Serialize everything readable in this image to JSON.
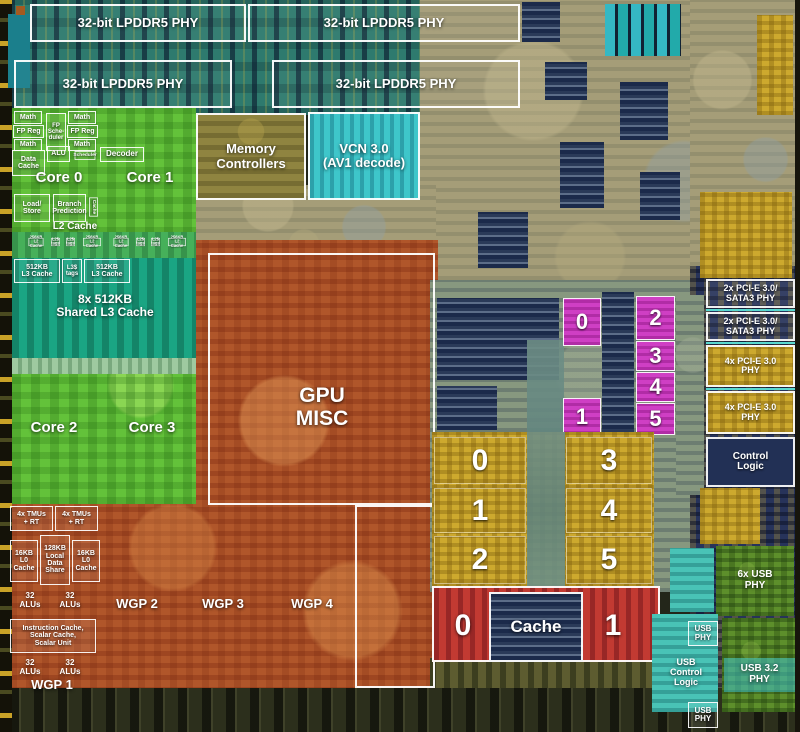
{
  "title": "Annotated APU die shot",
  "colors": {
    "cpu_green": "#63c23a",
    "l3_teal": "#1aa583",
    "gpu_orange": "#b0562a",
    "cu_pink": "#cf3fc4",
    "cu_yellow": "#cda92e",
    "cache_red": "#c23a32",
    "vcn_cyan": "#3ec6ca",
    "phy_teal": "#2e7a6e",
    "io_navy": "#27335a",
    "usb_green": "#5d8f2b",
    "usb_cyan": "#49c3b6",
    "mem_ctrl_olive": "#8f8440"
  },
  "die": {
    "phy": [
      "32-bit LPDDR5 PHY",
      "32-bit LPDDR5 PHY",
      "32-bit LPDDR5 PHY",
      "32-bit LPDDR5 PHY"
    ],
    "cpu": {
      "fpu_col1": [
        "Math",
        "FP Reg",
        "Math"
      ],
      "fp_scheduler": "FP Sche- duler",
      "fpu_col2": [
        "Math",
        "FP Reg",
        "Math"
      ],
      "data_cache": "Data\nCache",
      "alu": "ALU",
      "scheduler": "Scheduler",
      "decoder": "Decoder",
      "core0": "Core 0",
      "core1": "Core 1",
      "load_store": "Load/\nStore",
      "branch_prediction": "Branch\nPrediction",
      "l2_vertical": "Cache",
      "l2_cache": "L2 Cache",
      "l2_row": [
        "256KB\nL2 Cache",
        "L2$\ntags",
        "L2$\ntags",
        "256KB\nL2 Cache"
      ],
      "l3_row": [
        "512KB\nL3 Cache",
        "L3$\ntags",
        "512KB\nL3 Cache"
      ],
      "shared_l3": "8x 512KB\nShared L3 Cache",
      "core2": "Core 2",
      "core3": "Core 3"
    },
    "memory_controllers": "Memory\nControllers",
    "vcn": "VCN 3.0\n(AV1 decode)",
    "gpu_misc": "GPU\nMISC",
    "wgp": {
      "tmus": "4x TMUs\n+ RT",
      "l0_cache": "16KB\nL0\nCache",
      "lds": "128KB\nLocal\nData\nShare",
      "alus": "32\nALUs",
      "instruction": "Instruction Cache,\nScalar Cache,\nScalar Unit",
      "wgp1": "WGP 1",
      "wgp2": "WGP 2",
      "wgp3": "WGP 3",
      "wgp4": "WGP 4"
    },
    "cu_pink": {
      "left": [
        "0",
        "1"
      ],
      "right": [
        "2",
        "3",
        "4",
        "5"
      ]
    },
    "cu_yellow": {
      "left": [
        "0",
        "1",
        "2"
      ],
      "right": [
        "3",
        "4",
        "5"
      ]
    },
    "gpu_cache": {
      "left": "0",
      "label": "Cache",
      "right": "1"
    },
    "io": {
      "pcie_sata_1": "2x PCI-E 3.0/\nSATA3 PHY",
      "pcie_sata_2": "2x PCI-E 3.0/\nSATA3 PHY",
      "pcie_1": "4x PCI-E 3.0\nPHY",
      "pcie_2": "4x PCI-E 3.0\nPHY",
      "control_logic": "Control\nLogic",
      "usb_6x": "6x USB\nPHY",
      "usb_phy_top": "USB\nPHY",
      "usb_control": "USB\nControl\nLogic",
      "usb_32": "USB 3.2\nPHY",
      "usb_phy_bottom": "USB\nPHY"
    }
  }
}
